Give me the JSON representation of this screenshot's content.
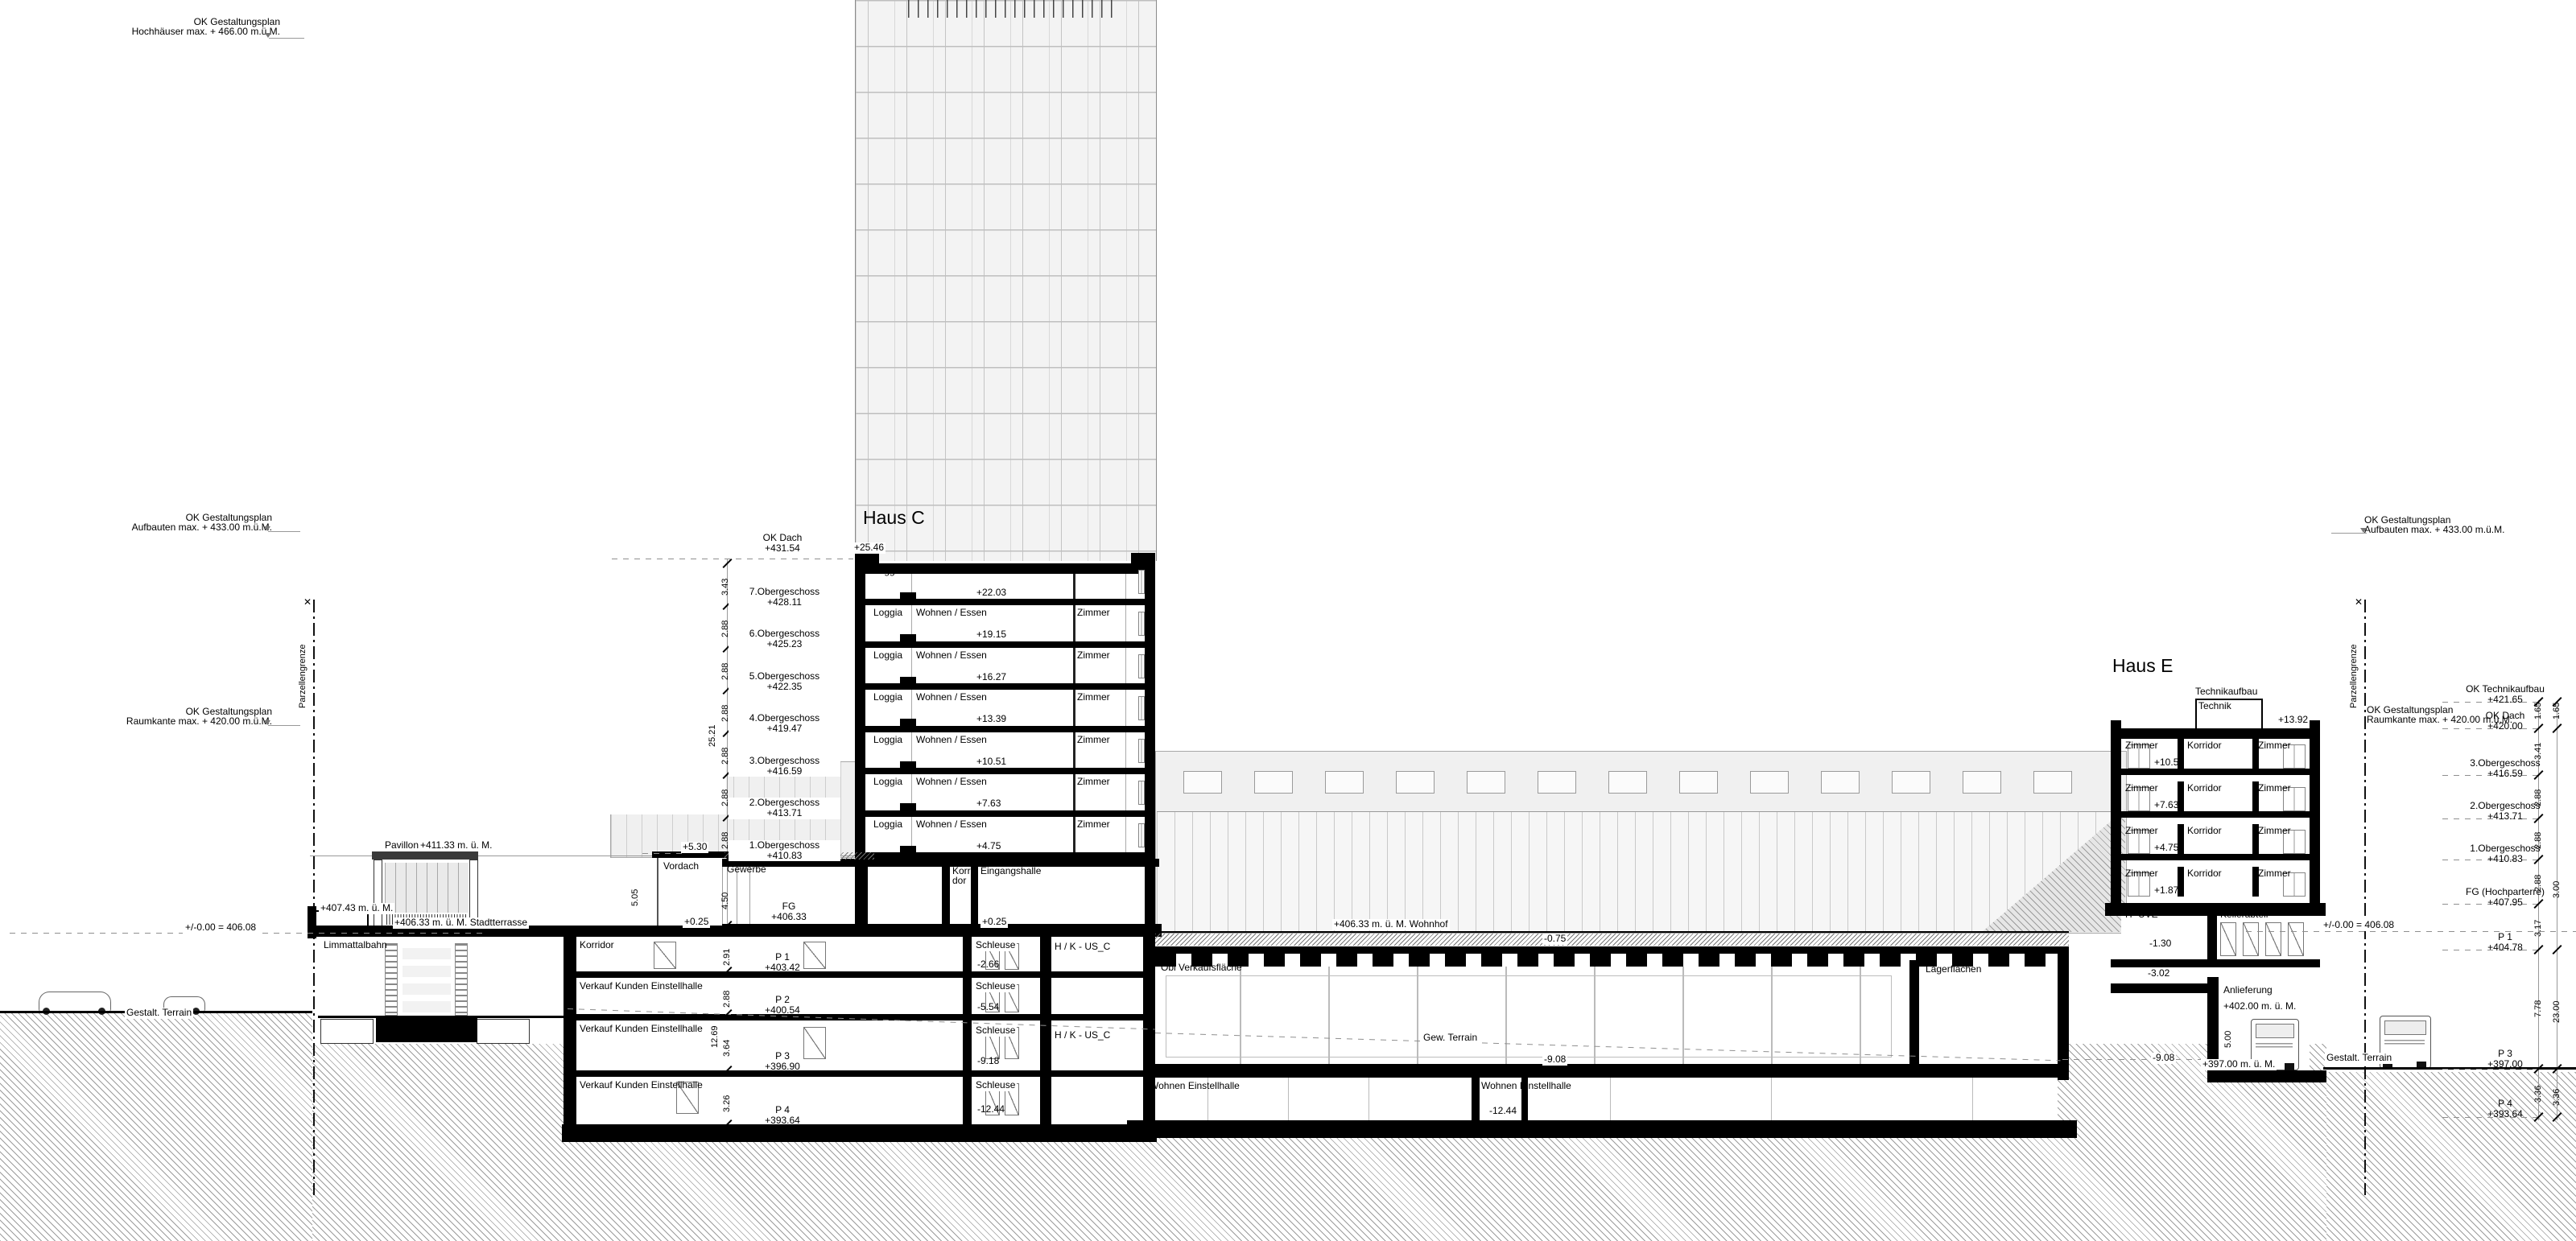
{
  "limits": {
    "hochhaus_l1": "OK Gestaltungsplan",
    "hochhaus_l2": "Hochhäuser max. + 466.00 m.ü.M.",
    "aufbauten_left_l1": "OK Gestaltungsplan",
    "aufbauten_left_l2": "Aufbauten max. + 433.00 m.ü.M.",
    "raumkante_left_l1": "OK Gestaltungsplan",
    "raumkante_left_l2": "Raumkante max. + 420.00 m.ü.M.",
    "aufbauten_right_l1": "OK Gestaltungsplan",
    "aufbauten_right_l2": "Aufbauten max. + 433.00 m.ü.M.",
    "raumkante_right_l1": "OK Gestaltungsplan",
    "raumkante_right_l2": "Raumkante max. + 420.00 m.ü.M."
  },
  "parzellengrenze": "Parzellengrenze",
  "haus_c": {
    "title": "Haus C",
    "ok_dach_l1": "OK Dach",
    "ok_dach_l2": "+431.54",
    "roof_rel": "+25.46",
    "rooms": [
      "Loggia",
      "Wohnen / Essen",
      "Zimmer"
    ],
    "floors": [
      {
        "name": "7.Obergeschoss",
        "abs": "+428.11",
        "rel": "+22.03",
        "dim": "3.43"
      },
      {
        "name": "6.Obergeschoss",
        "abs": "+425.23",
        "rel": "+19.15",
        "dim": "2.88"
      },
      {
        "name": "5.Obergeschoss",
        "abs": "+422.35",
        "rel": "+16.27",
        "dim": "2.88"
      },
      {
        "name": "4.Obergeschoss",
        "abs": "+419.47",
        "rel": "+13.39",
        "dim": "2.88"
      },
      {
        "name": "3.Obergeschoss",
        "abs": "+416.59",
        "rel": "+10.51",
        "dim": "2.88"
      },
      {
        "name": "2.Obergeschoss",
        "abs": "+413.71",
        "rel": "+7.63",
        "dim": "2.88"
      },
      {
        "name": "1.Obergeschoss",
        "abs": "+410.83",
        "rel": "+4.75",
        "dim": "2.88"
      }
    ],
    "dims": {
      "total_upper": "25.21",
      "eg_height": "4.50",
      "vordach_chain": "5.05"
    },
    "ground": {
      "vordach": "Vordach",
      "vordach_rel": "+5.30",
      "gewerbe": "Gewerbe",
      "korridor_l1": "Korri-",
      "korridor_l2": "dor",
      "eingangshalle": "Eingangshalle",
      "fg_l1": "FG",
      "fg_l2": "+406.33",
      "rel_left": "+0.25",
      "rel_right": "+0.25"
    }
  },
  "basement": {
    "schleuse": "Schleuse",
    "hk_1": "H / K - US_C",
    "hk_2": "H / K - US_C",
    "total_dim": "12.69",
    "rows": [
      {
        "hall": "Korridor",
        "name": "P 1",
        "abs": "+403.42",
        "schleuse_rel": "-2.66",
        "dim": "2.91"
      },
      {
        "hall": "Verkauf Kunden Einstellhalle",
        "name": "P 2",
        "abs": "+400.54",
        "schleuse_rel": "-5.54",
        "dim": "2.88"
      },
      {
        "hall": "Verkauf Kunden Einstellhalle",
        "name": "P 3",
        "abs": "+396.90",
        "schleuse_rel": "-9.18",
        "dim": "3.64"
      },
      {
        "hall": "Verkauf Kunden Einstellhalle",
        "name": "P 4",
        "abs": "+393.64",
        "schleuse_rel": "-12.44",
        "dim": "3.26"
      }
    ]
  },
  "hall": {
    "wohnhof": "+406.33 m. ü. M.  Wohnhof",
    "deck_rel": "-0.75",
    "verkauf": "Obi Verkaufsfläche",
    "gew_terrain": "Gew. Terrain",
    "rel_908_a": "-9.08",
    "rel_908_b": "-9.08",
    "lager": "Lagerflächen",
    "wohnen_eh_a": "Wohnen Einstellhalle",
    "wohnen_eh_b": "Wohnen Einstellhalle",
    "wohnen_eh_rel": "-12.44"
  },
  "haus_e": {
    "title": "Haus E",
    "technikaufbau": "Technikaufbau",
    "technik": "Technik",
    "roof_rel": "+13.92",
    "rooms": [
      "Zimmer",
      "Korridor",
      "Zimmer"
    ],
    "floors": [
      {
        "rel": "+10.51"
      },
      {
        "rel": "+7.63"
      },
      {
        "rel": "+4.75"
      },
      {
        "rel": "+1.87"
      }
    ],
    "huve": "H -UVE",
    "huve_rel": "-1.30",
    "keller": "Kellerabteil",
    "ug2_rel": "-3.02",
    "anlieferung": "Anlieferung",
    "anlieferung_abs": "+402.00 m. ü. M.",
    "anlieferung_dim": "5.00",
    "anlieferung_floor": "+397.00 m. ü. M."
  },
  "right_col": {
    "rows": [
      {
        "l1": "OK Technikaufbau",
        "l2": "+421.65"
      },
      {
        "l1": "OK Dach",
        "l2": "+420.00"
      },
      {
        "l1": "3.Obergeschoss",
        "l2": "+416.59"
      },
      {
        "l1": "2.Obergeschoss",
        "l2": "+413.71"
      },
      {
        "l1": "1.Obergeschoss",
        "l2": "+410.83"
      },
      {
        "l1": "FG (Hochparterre)",
        "l2": "+407.95"
      },
      {
        "l1": "P 1",
        "l2": "+404.78"
      },
      {
        "l1": "P 3",
        "l2": "+397.00"
      },
      {
        "l1": "P 4",
        "l2": "+393.64"
      }
    ],
    "dims_inner": [
      "1.65",
      "3.41",
      "2.88",
      "2.88",
      "2.88",
      "3.17",
      "7.78",
      "3.36"
    ],
    "dims_outer": [
      "1.65",
      "3.00",
      "23.00",
      "3.36"
    ]
  },
  "site": {
    "datum_left": "+/-0.00 = 406.08",
    "datum_right": "+/-0.00 = 406.08",
    "terrain_left": "Gestalt. Terrain",
    "terrain_right": "Gestalt. Terrain",
    "pavillon": "Pavillon",
    "pavillon_abs": "+411.33 m. ü. M.",
    "abs_40743": "+407.43 m. ü. M.",
    "stadtterrasse": "+406.33 m. ü. M.  Stadtterrasse",
    "limmattalbahn": "Limmattalbahn"
  }
}
